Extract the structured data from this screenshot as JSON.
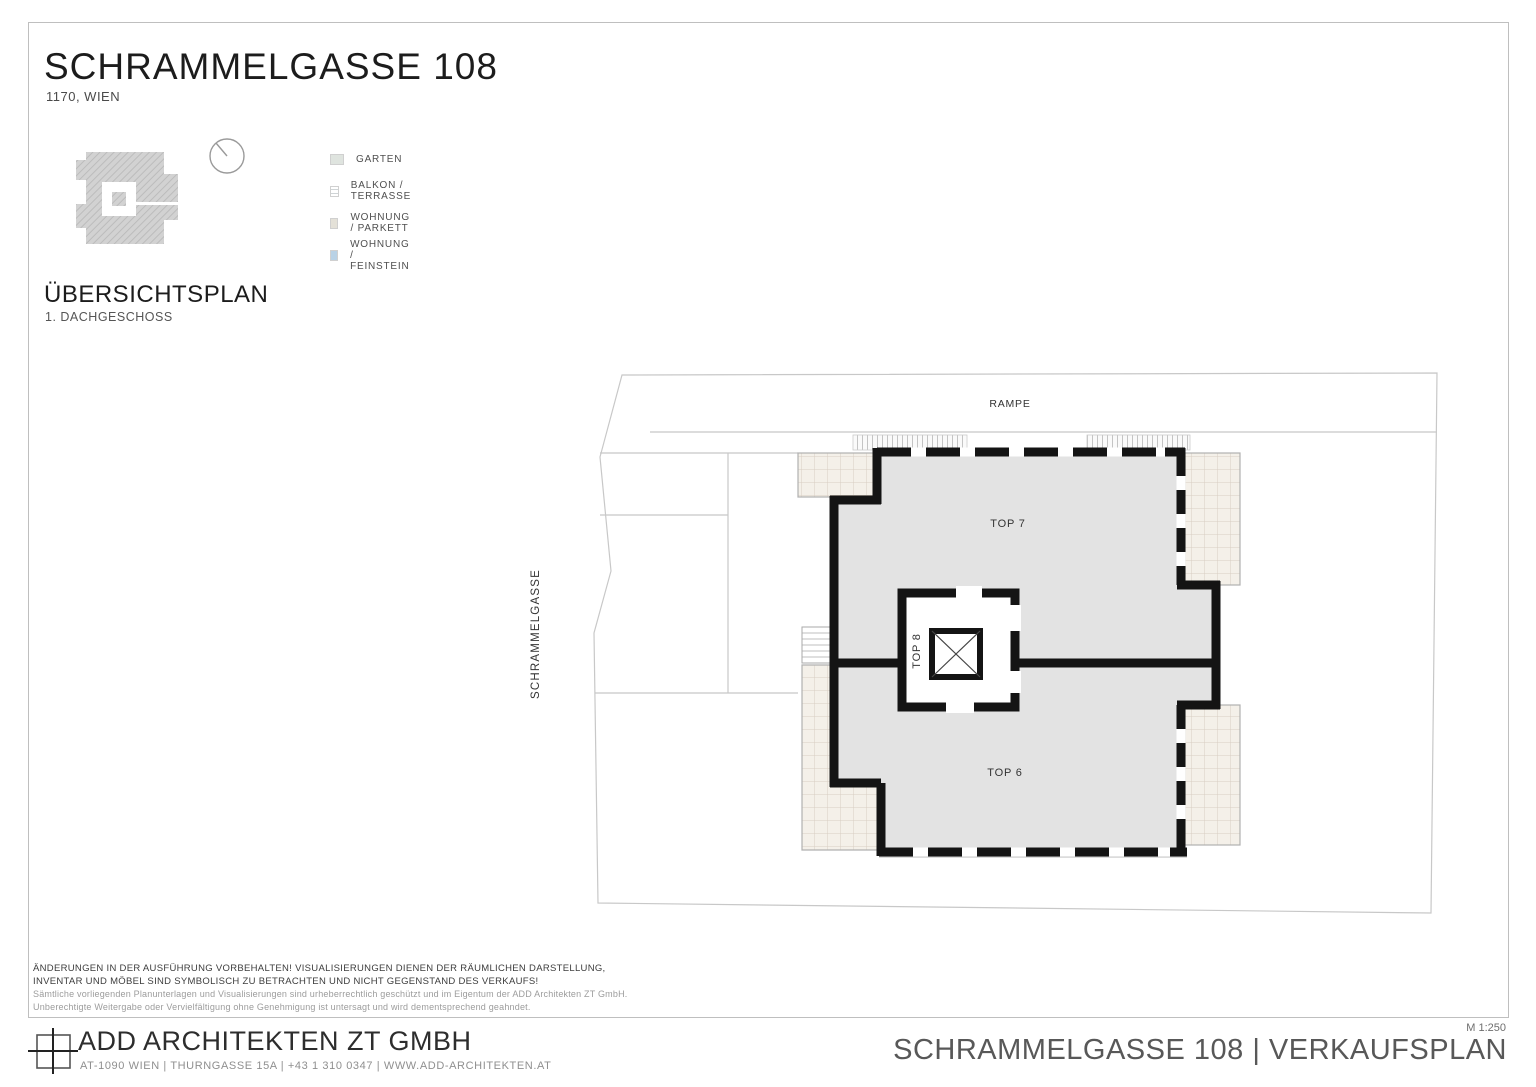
{
  "sheet": {
    "title": "SCHRAMMELGASSE 108",
    "subtitle": "1170, WIEN",
    "overview_heading": "ÜBERSICHTSPLAN",
    "overview_subheading": "1. DACHGESCHOSS"
  },
  "legend": {
    "items": [
      {
        "label": "GARTEN",
        "color": "#dfe4df",
        "pattern": "solid"
      },
      {
        "label": "BALKON / TERRASSE",
        "color": "#ffffff",
        "pattern": "horizontal-stripes"
      },
      {
        "label": "WOHNUNG / PARKETT",
        "color": "#e4e1d8",
        "pattern": "solid"
      },
      {
        "label": "WOHNUNG / FEINSTEIN",
        "color": "#b9d2e6",
        "pattern": "solid"
      }
    ]
  },
  "plan": {
    "street_label": "SCHRAMMELGASSE",
    "ramp_label": "RAMPE",
    "units": [
      {
        "id": "TOP 7"
      },
      {
        "id": "TOP 8"
      },
      {
        "id": "TOP 6"
      }
    ],
    "colors": {
      "apartment_fill": "#e3e3e3",
      "terrace_fill": "#f4f0e9",
      "terrace_grid": "#d8cec2",
      "wall": "#141414",
      "site_line": "#c8c8c8"
    }
  },
  "disclaimer": {
    "line1": "ÄNDERUNGEN IN DER AUSFÜHRUNG VORBEHALTEN! VISUALISIERUNGEN DIENEN DER RÄUMLICHEN DARSTELLUNG,",
    "line2": "INVENTAR UND MÖBEL SIND SYMBOLISCH ZU BETRACHTEN UND NICHT GEGENSTAND DES VERKAUFS!",
    "line3": "Sämtliche vorliegenden Planunterlagen und Visualisierungen sind urheberrechtlich geschützt und im Eigentum der ADD Architekten ZT GmbH.",
    "line4": "Unberechtigte Weitergabe oder Vervielfältigung ohne Genehmigung ist untersagt und wird dementsprechend geahndet."
  },
  "footer": {
    "company": "ADD ARCHITEKTEN ZT GMBH",
    "address": "AT-1090 WIEN | THURNGASSE 15A | +43 1 310 0347 | WWW.ADD-ARCHITEKTEN.AT",
    "plan_title": "SCHRAMMELGASSE 108 | VERKAUFSPLAN",
    "scale": "M 1:250"
  }
}
